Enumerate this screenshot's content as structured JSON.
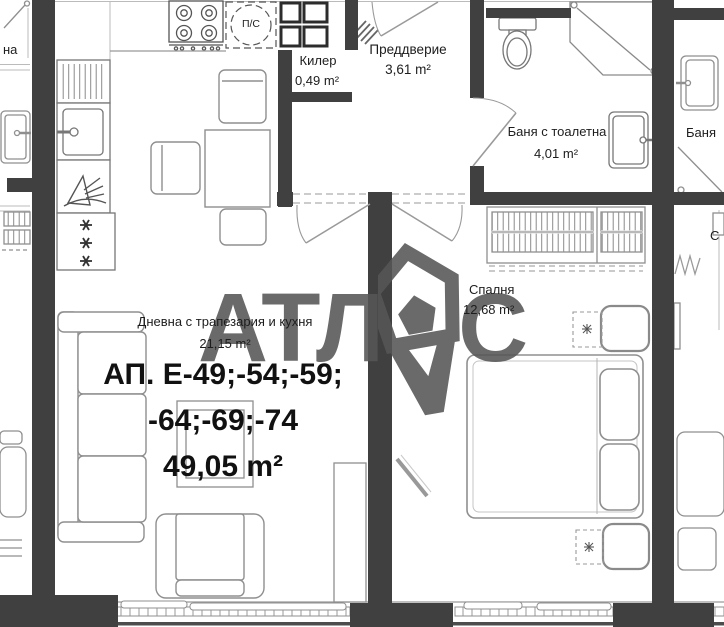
{
  "rooms": [
    {
      "name": "Килер",
      "area": "0,49 m²"
    },
    {
      "name": "Преддверие",
      "area": "3,61 m²"
    },
    {
      "name": "Баня с тоалетна",
      "area": "4,01 m²"
    },
    {
      "name": "Дневна с трапезария и кухня",
      "area": "21,15 m²"
    },
    {
      "name": "Спалня",
      "area": "12,68 m²"
    }
  ],
  "apartment_label": {
    "line1": "АП. Е-49;-54;-59;",
    "line2": "-64;-69;-74",
    "line3": "49,05 m²"
  },
  "fixtures": {
    "washer_label": "П/С"
  },
  "watermark": {
    "left": "АТЛ",
    "right": "С"
  },
  "neighbors": {
    "left_partial": "на",
    "right_bath": "Баня",
    "right_partial": "С"
  },
  "colors": {
    "wall": "#404040",
    "furniture_line": "#8f8f8f",
    "text": "#1d1d1d",
    "watermark": "#565656"
  }
}
